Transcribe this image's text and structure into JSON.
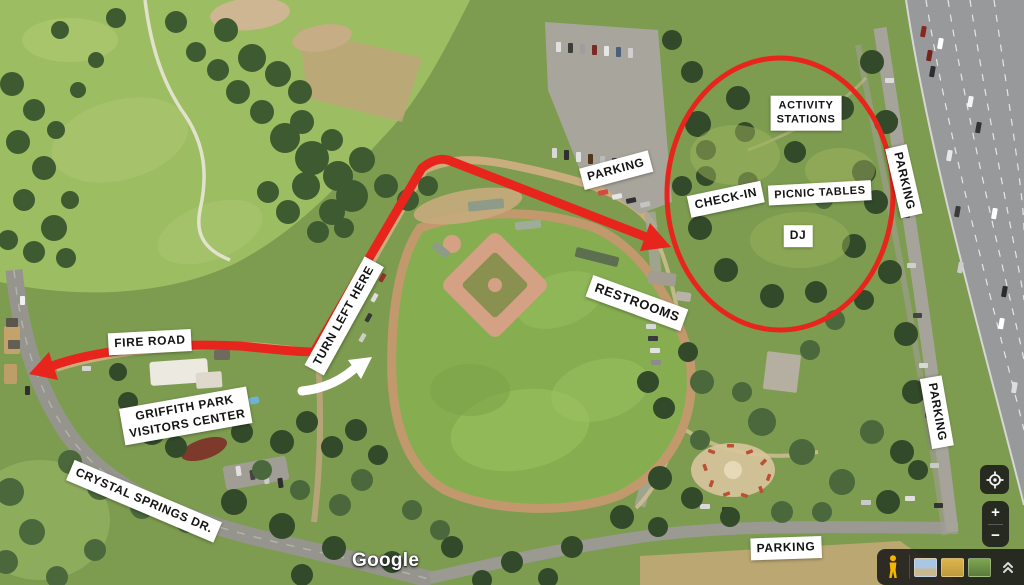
{
  "map": {
    "kind": "satellite",
    "annotation_color": "#e8251d",
    "label_background": "#ffffff",
    "label_text_color": "#141414"
  },
  "labels": {
    "fire_road": "FIRE ROAD",
    "turn_left_here": "TURN LEFT HERE",
    "visitors_center": "GRIFFITH PARK\nVISITORS CENTER",
    "crystal_springs": "CRYSTAL SPRINGS DR.",
    "parking_north": "PARKING",
    "restrooms": "RESTROOMS",
    "check_in": "CHECK-IN",
    "picnic_tables": "PICNIC TABLES",
    "activity_stations": "ACTIVITY\nSTATIONS",
    "dj": "DJ",
    "parking_east_upper": "PARKING",
    "parking_east_lower": "PARKING",
    "parking_south": "PARKING"
  },
  "controls": {
    "zoom_in": "+",
    "zoom_out": "−"
  },
  "attribution": {
    "logo": "Google"
  }
}
